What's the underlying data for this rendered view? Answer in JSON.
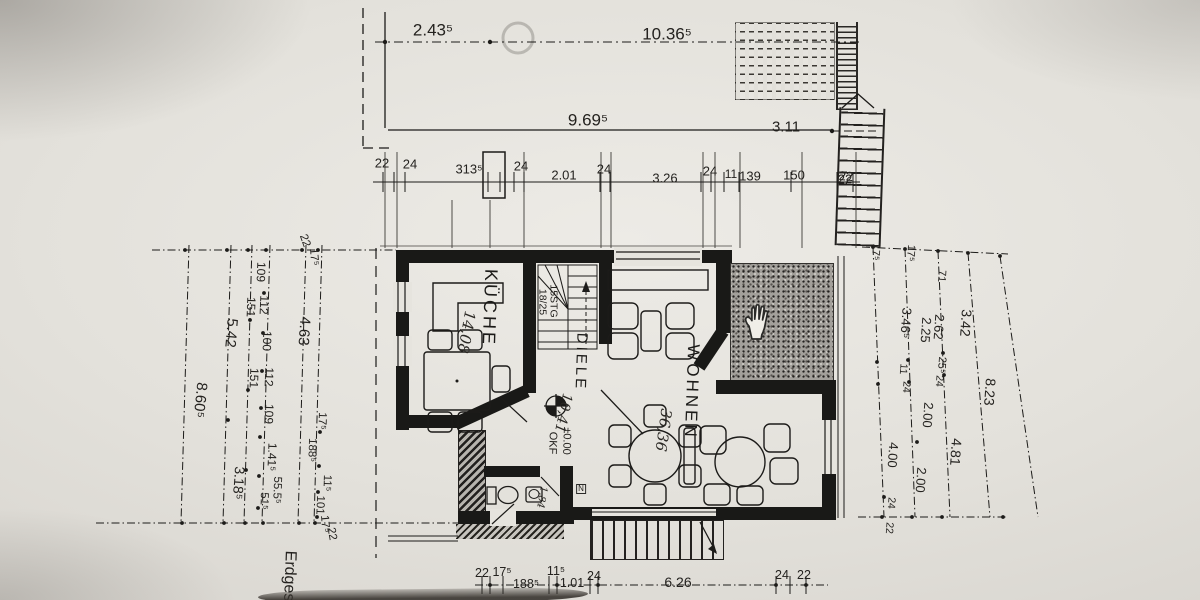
{
  "photo": {
    "floor_label": "Erdges"
  },
  "rooms": {
    "kitchen": {
      "name": "KÜCHE",
      "area": "14,08"
    },
    "hallway": {
      "name": "DIELE",
      "area": "10,41"
    },
    "living_room": {
      "name": "WOHNEN",
      "area": "36,36"
    },
    "wc": {
      "area": "1,84",
      "marker": "N"
    }
  },
  "stair": {
    "flights": "15STG",
    "ratio": "18/25",
    "exterior_width": "22"
  },
  "level_marker": {
    "value": "±0.00",
    "datum": "OKF"
  },
  "dimensions": {
    "top": [
      "2.43⁵",
      "10.36⁵",
      "9.69⁵",
      "3.11"
    ],
    "wall_row": [
      "22",
      "24",
      "313⁵",
      "24",
      "2.01",
      "24",
      "3.26",
      "24",
      "11",
      "139",
      "150",
      "22"
    ],
    "left": {
      "corner_top": [
        "22",
        "17⁵"
      ],
      "outer": [
        "8.60⁵"
      ],
      "mid": [
        "5.42",
        "3.18⁵"
      ],
      "thirds": [
        "151",
        "151",
        "51⁵"
      ],
      "inner": [
        "109",
        "112",
        "100",
        "112",
        "109",
        "1.41⁵",
        "55.5⁵"
      ],
      "wall": [
        "4.63",
        "17⁵",
        "188⁵",
        "11⁵",
        "101"
      ],
      "corner_bottom": [
        "17⁵",
        "22"
      ]
    },
    "right": [
      "17⁵",
      "17⁵",
      "71",
      "3.46⁵",
      "2.25",
      "2.62",
      "3.42",
      "11",
      "24",
      "25⁵",
      "24",
      "2.00",
      "4.00",
      "2.00",
      "4.81",
      "8.23",
      "24",
      "22"
    ],
    "bottom": [
      "22",
      "17⁵",
      "188⁵",
      "11⁵",
      "1.01",
      "24",
      "6.26",
      "24",
      "22"
    ]
  },
  "colors": {
    "paper": "#e3e1db",
    "ink": "#1c1b19",
    "terrace_fill": "#a3a09b"
  }
}
